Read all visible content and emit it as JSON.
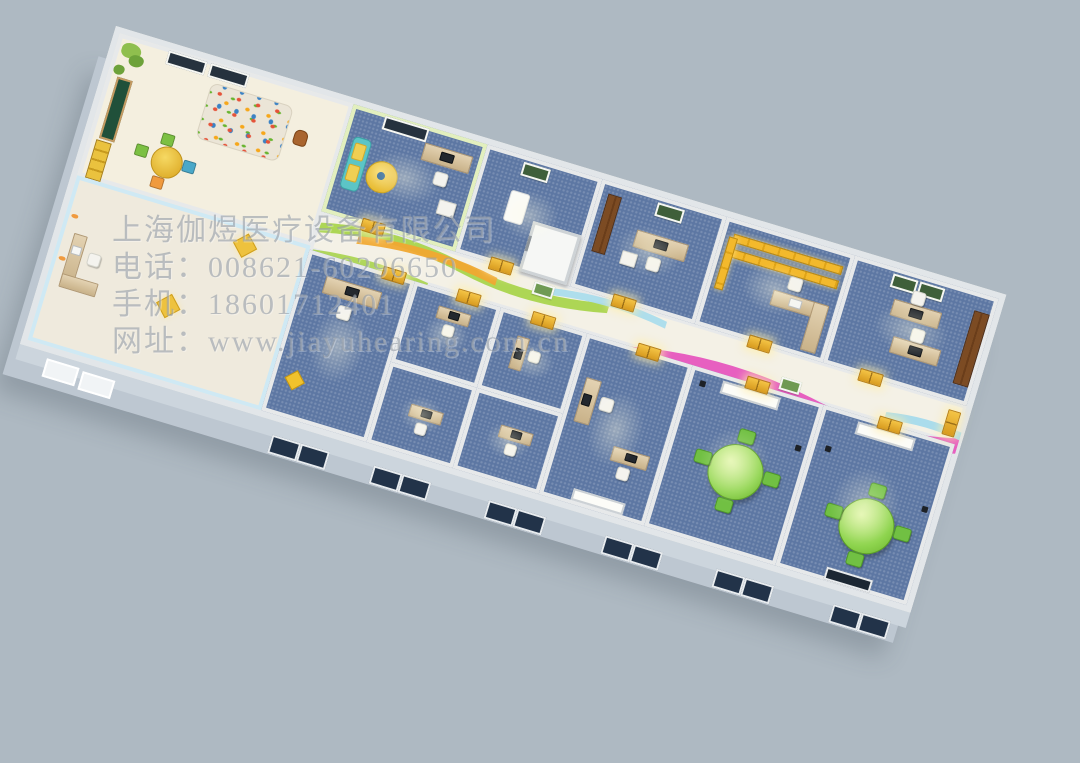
{
  "watermark": {
    "company": "上海伽煜医疗设备有限公司",
    "phone": "电话：008621-60296650",
    "mobile": "手机：18601712401",
    "website": "网址：www.jiayuhearing.com.cn"
  },
  "palette": {
    "background": "#aeb9c2",
    "wall": "#e7e9ea",
    "wall_face": "#c8d1d9",
    "carpet_blue": "#5d77a3",
    "corridor_floor": "#f4f1e6",
    "kids_floor": "#f4efdf",
    "door_yellow": "#e9b330",
    "wave_green": "#a9d44d",
    "wave_orange": "#f0a832",
    "wave_blue": "#aadcec",
    "wave_pink": "#e75fc0",
    "sofa_teal": "#5cc5c6",
    "kids_wall_green": "#e2efbe",
    "entry_wall_blue": "#cfe9f4",
    "group_table_green": "#8ed44e",
    "desk_wood": "#d6c09c",
    "wardrobe_brown": "#7a4a22",
    "chalkboard_green": "#20503a"
  }
}
